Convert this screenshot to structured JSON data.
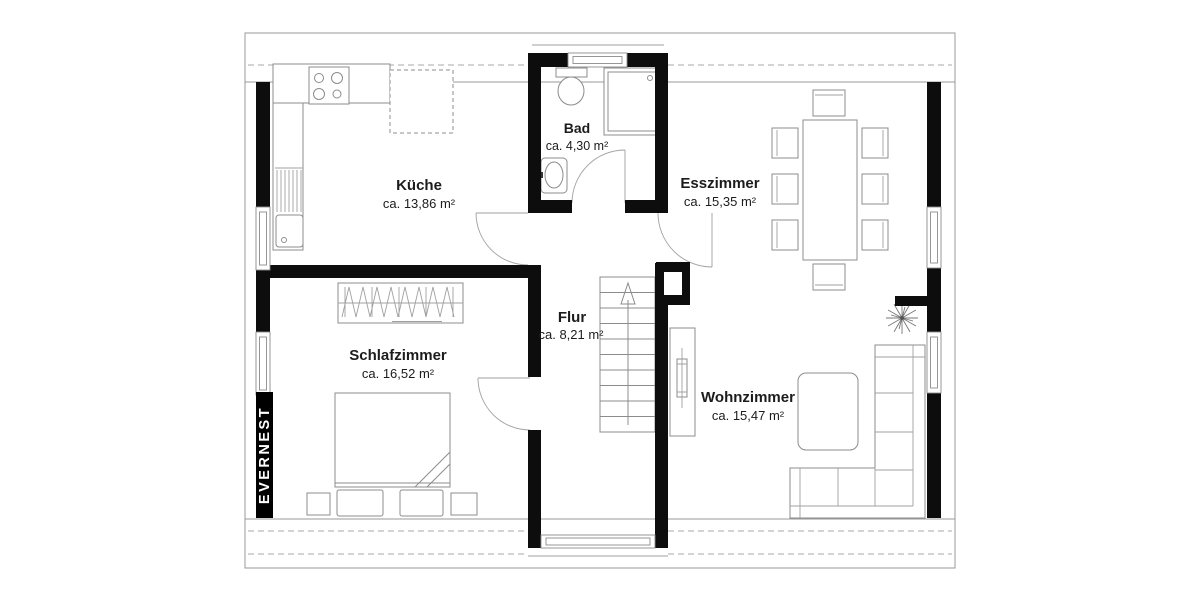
{
  "watermark": "EVERNEST",
  "rooms": {
    "kueche": {
      "name": "Küche",
      "area": "ca. 13,86 m²"
    },
    "bad": {
      "name": "Bad",
      "area": "ca. 4,30 m²"
    },
    "esszimmer": {
      "name": "Esszimmer",
      "area": "ca. 15,35 m²"
    },
    "schlafzimmer": {
      "name": "Schlafzimmer",
      "area": "ca. 16,52 m²"
    },
    "flur": {
      "name": "Flur",
      "area": "ca. 8,21 m²"
    },
    "wohnzimmer": {
      "name": "Wohnzimmer",
      "area": "ca. 15,47 m²"
    }
  },
  "colors": {
    "wall": "#0d0d0d",
    "line": "#8c8c8c",
    "hatch": "#858585",
    "label": "#1c1c1c",
    "background": "#ffffff"
  }
}
